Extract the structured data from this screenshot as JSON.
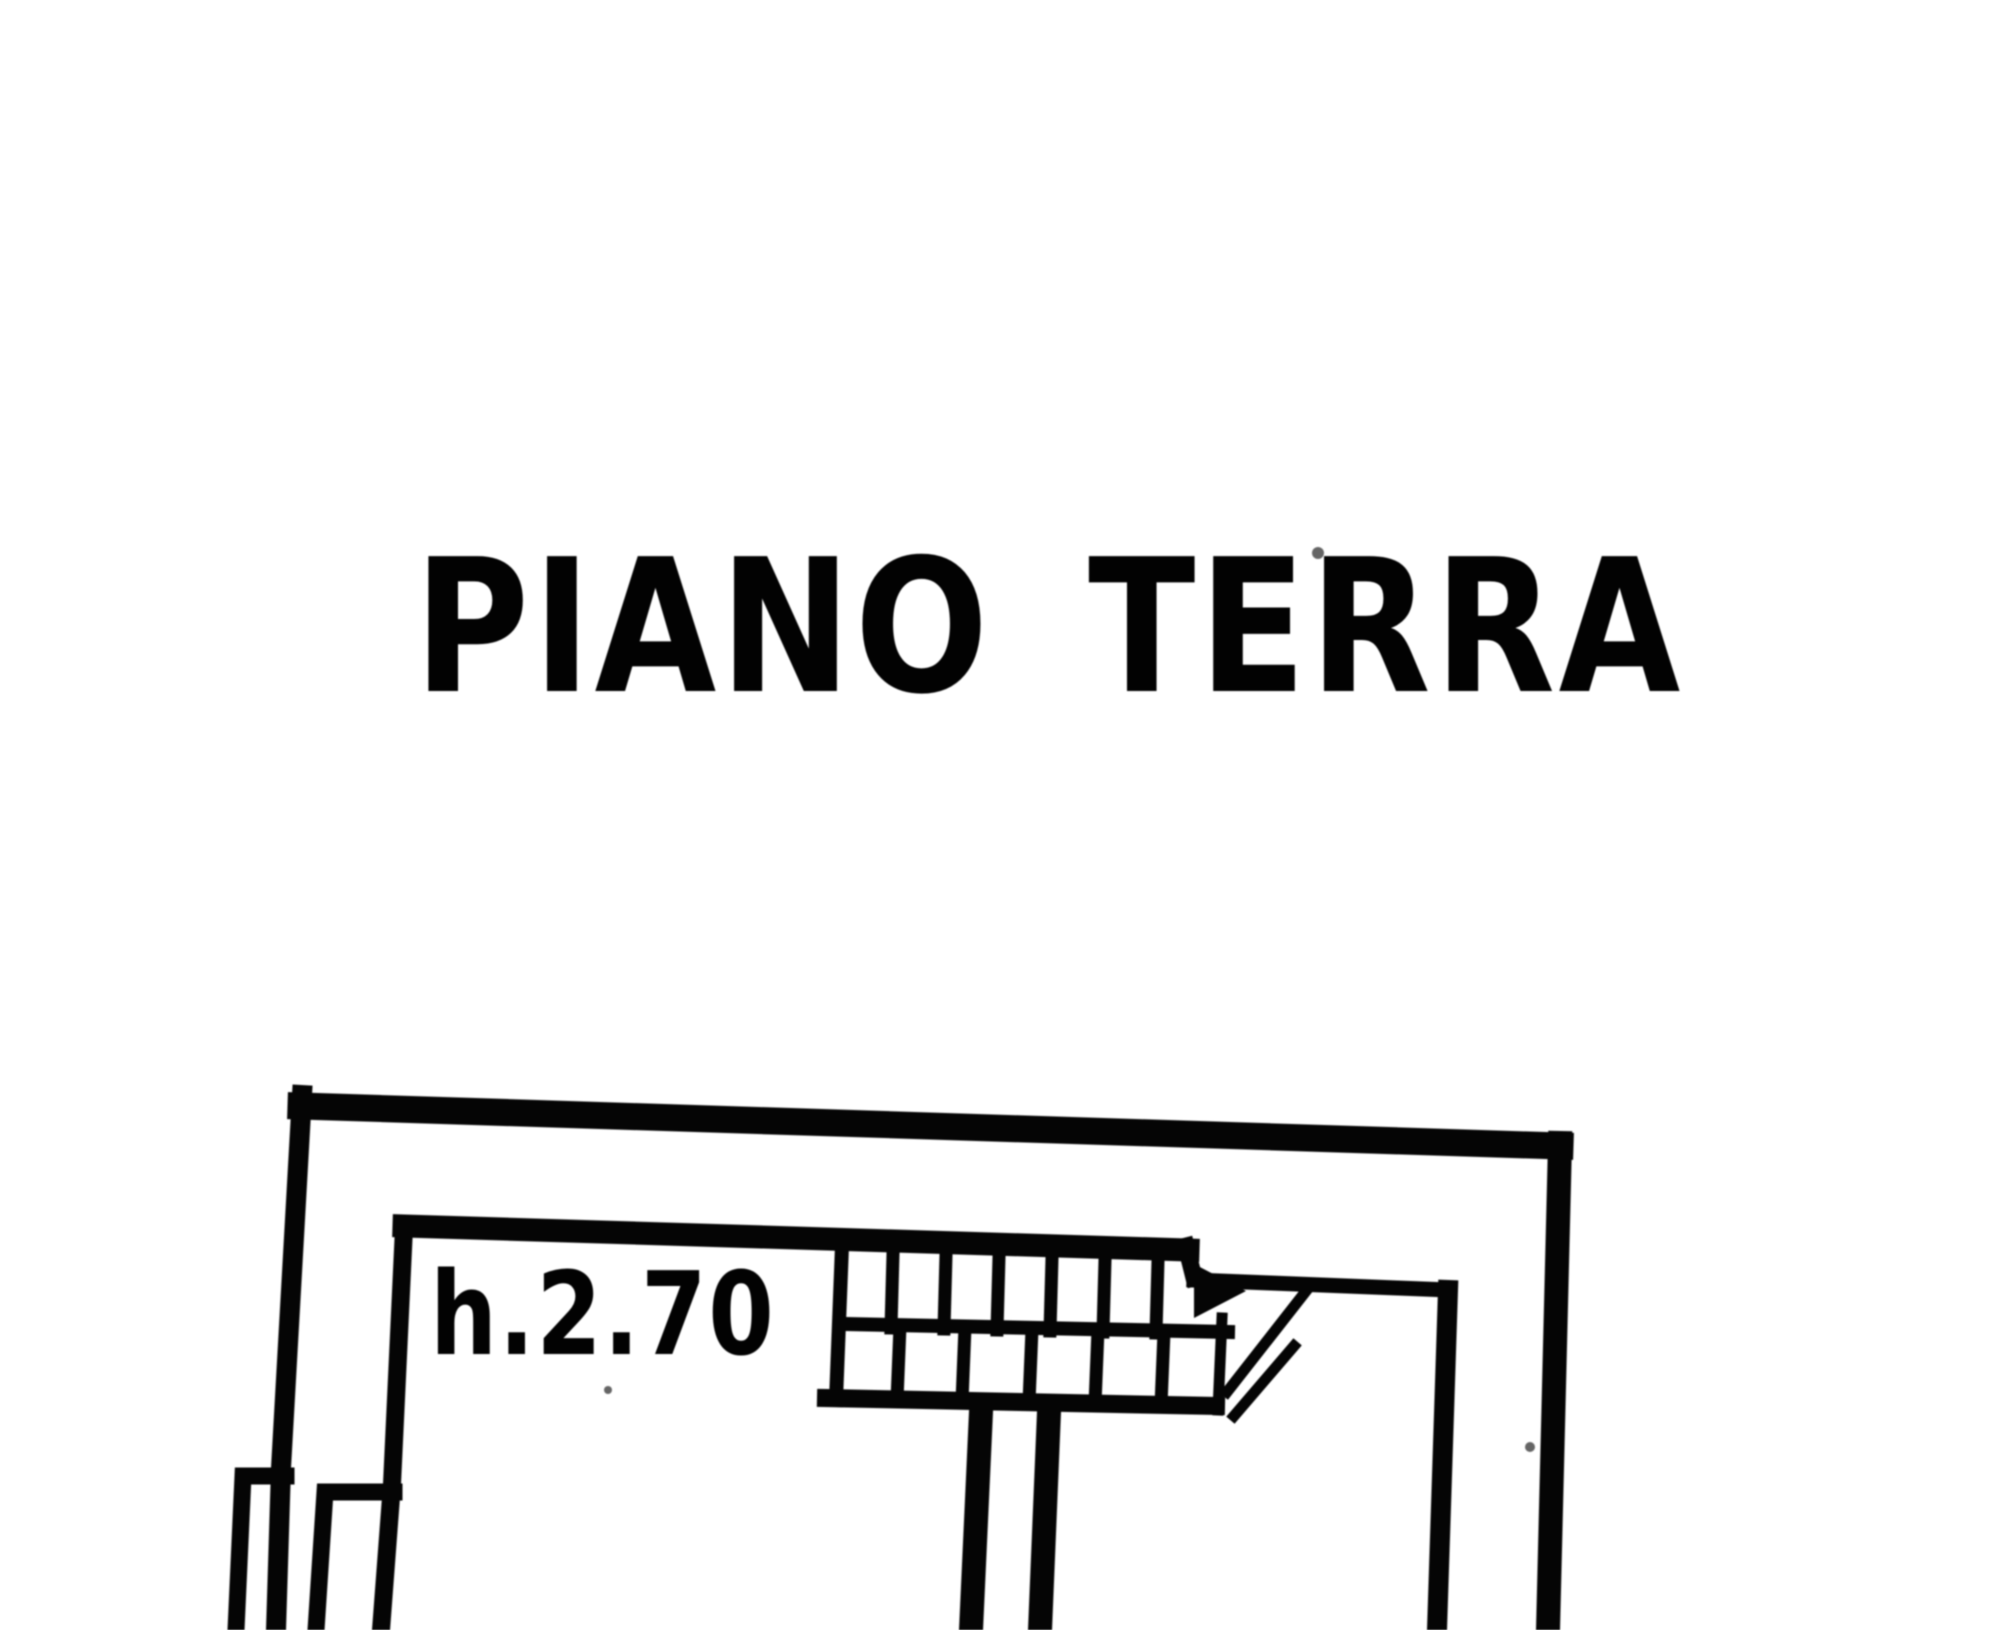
{
  "page": {
    "kind": "scanned cadastral floor plan sheet",
    "paper_color": "#ffffff",
    "ink_color": "#0e0e0e"
  },
  "title": {
    "text": "PIANO TERRA"
  },
  "plan": {
    "height_annotation": "h.2.70",
    "elements": [
      "outer-perimeter-wall",
      "inner-wall-line",
      "staircase-with-steps",
      "stair-direction-arrow",
      "stair-section-cut-line",
      "stairwell-walls-descending",
      "stepped-left-wall"
    ]
  }
}
